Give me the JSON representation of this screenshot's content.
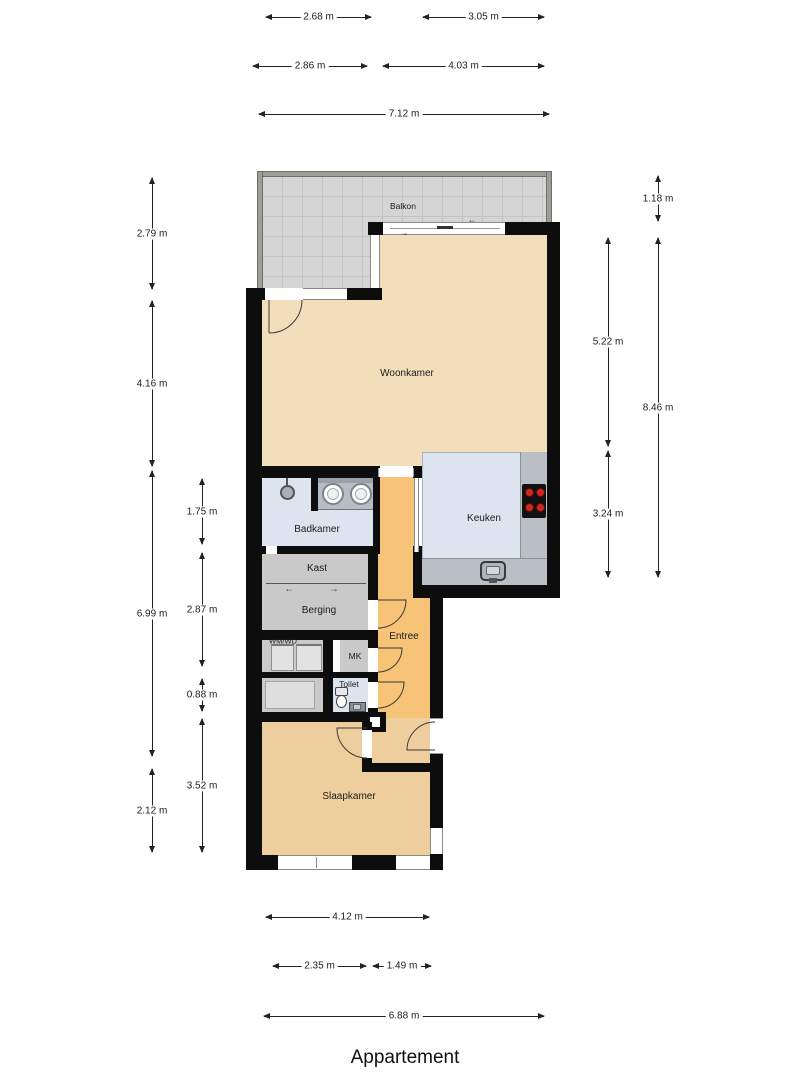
{
  "title": "Appartement",
  "rooms": {
    "balkon": "Balkon",
    "woonkamer": "Woonkamer",
    "keuken": "Keuken",
    "badkamer": "Badkamer",
    "kast": "Kast",
    "berging": "Berging",
    "wmwd": "WM/WD",
    "mk": "MK",
    "toilet": "Toilet",
    "entree": "Entree",
    "slaapkamer": "Slaapkamer"
  },
  "dims": {
    "h": [
      "2.68 m",
      "3.05 m",
      "2.86 m",
      "4.03 m",
      "7.12 m",
      "4.12 m",
      "2.35 m",
      "1.49 m",
      "6.88 m"
    ],
    "v": [
      "2.79 m",
      "4.16 m",
      "6.99 m",
      "2.12 m",
      "1.75 m",
      "2.87 m",
      "0.88 m",
      "3.52 m",
      "5.22 m",
      "3.24 m",
      "1.18 m",
      "8.46 m"
    ]
  },
  "arrows": {
    "left": "←",
    "right": "→"
  },
  "colors": {
    "wall": "#0d0d0d",
    "living": "#f2deba",
    "bedroom": "#efce9e",
    "entry": "#f6c377",
    "wet_rooms": "#dbe4ef",
    "storage": "#c9c9c9",
    "balcony": "#d5d5d5",
    "counter": "#b9bfc5",
    "burner": "#cc2a1f"
  }
}
